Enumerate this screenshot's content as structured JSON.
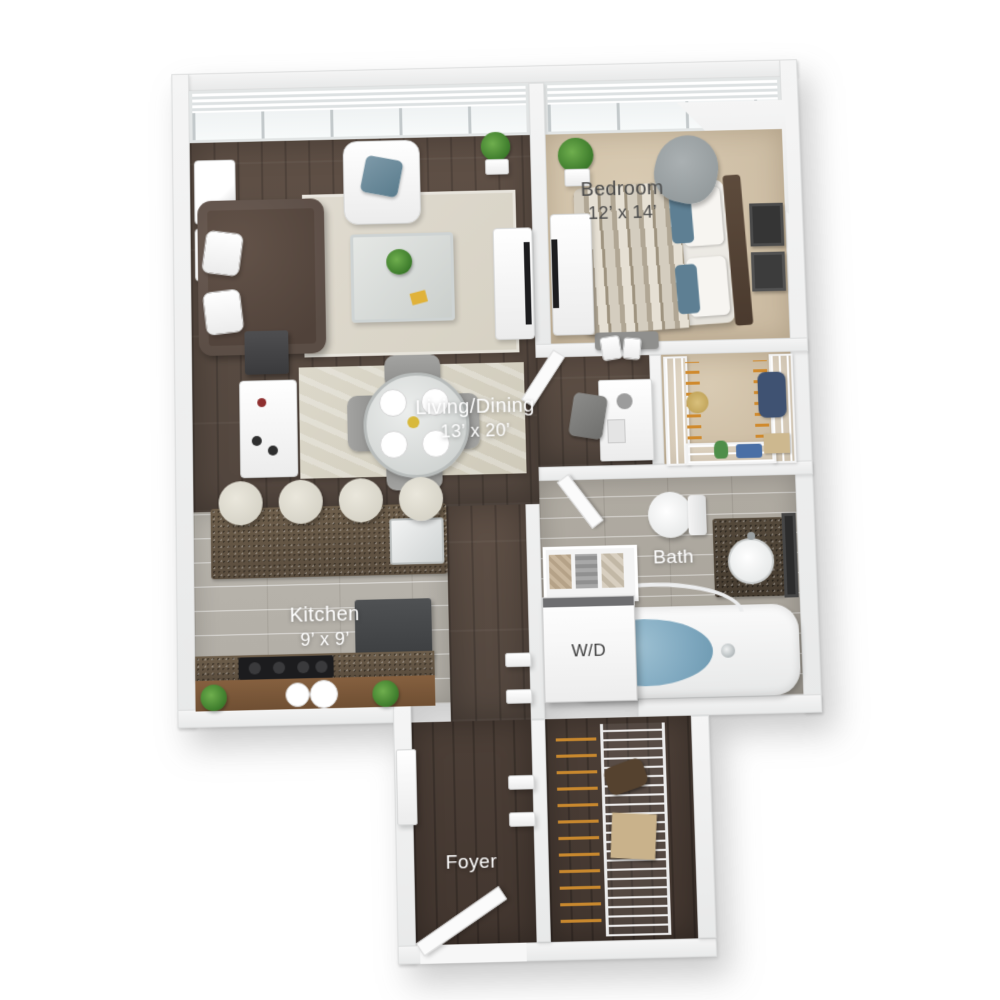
{
  "meta": {
    "title": "One-bedroom apartment 3D floor plan",
    "view": "top-down 3D render"
  },
  "rooms": {
    "bedroom": {
      "label": "Bedroom",
      "dims": "12’ x 14’"
    },
    "living_dining": {
      "label": "Living/Dining",
      "dims": "13’ x 20’"
    },
    "kitchen": {
      "label": "Kitchen",
      "dims": "9’ x 9’"
    },
    "bath": {
      "label": "Bath"
    },
    "laundry": {
      "label": "W/D"
    },
    "foyer": {
      "label": "Foyer"
    }
  },
  "colors": {
    "wall": "#eceded",
    "wood_living": "#5a4c43",
    "wood_foyer": "#473b33",
    "carpet_tan": "#d2c3ab",
    "tile_kitchen": "#b7b3ab",
    "tile_bath": "#aba69d",
    "granite": "#63553f",
    "tub_water": "#7fa8bf",
    "accent_teal": "#5e7f93",
    "hanger_orange": "#d08a2d",
    "label_light": "#ffffff",
    "label_dark": "#4a4a4a"
  },
  "furnishings": {
    "living_dining": [
      "chesterfield-sofa",
      "white-armchair",
      "glass-coffee-table",
      "area-rug",
      "round-dining-table",
      "four-dining-chairs",
      "bar-cart",
      "console-table",
      "tv-console",
      "wall-art",
      "potted-plant"
    ],
    "bedroom": [
      "queen-bed",
      "patterned-duvet",
      "accent-chair",
      "media-dresser",
      "bench-with-bags",
      "wall-art",
      "potted-plant"
    ],
    "kitchen": [
      "granite-island-with-sink",
      "four-bar-stools",
      "range-cooktop",
      "refrigerator",
      "counter-plants",
      "plates"
    ],
    "bath": [
      "toilet",
      "vanity-with-round-sink",
      "mirror",
      "soaking-tub",
      "shower-rod"
    ],
    "closets": [
      "walk-in-closet-wire-shelving",
      "linen-shelf-baskets",
      "foyer-closet-wire-shelving"
    ],
    "laundry": [
      "stacked-washer-dryer"
    ],
    "foyer": [
      "entry-door-open",
      "wall-shelves"
    ]
  }
}
